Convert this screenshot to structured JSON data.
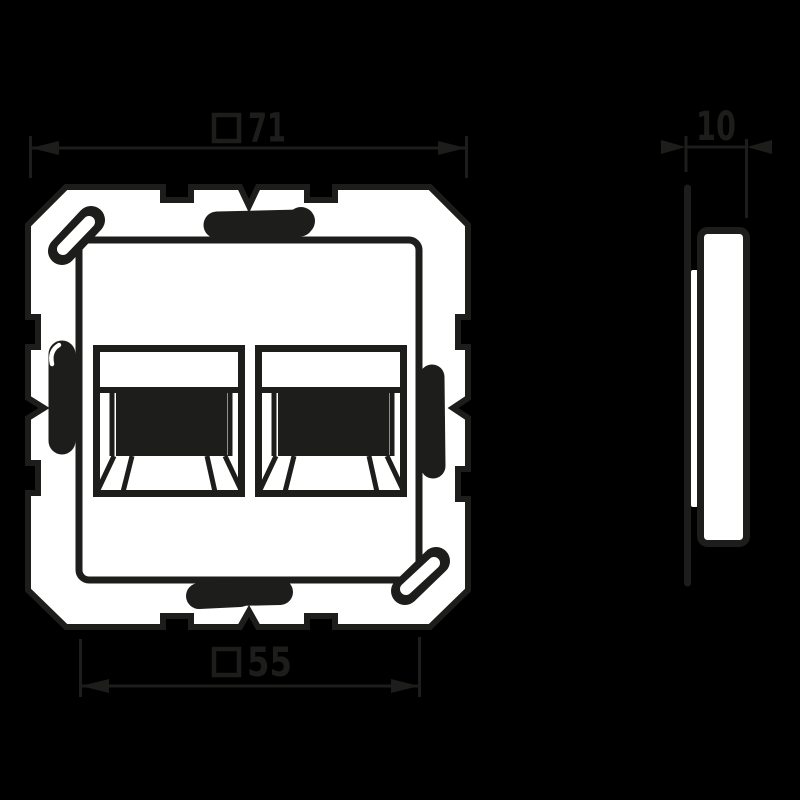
{
  "drawing": {
    "kind": "technical dimension drawing",
    "subject": "2-port modular jack cover plate with mounting frame",
    "views": [
      {
        "id": "front",
        "label": "front view"
      },
      {
        "id": "side",
        "label": "side view"
      }
    ]
  },
  "dimensions": {
    "outer_width": {
      "symbol": "□",
      "value": "71"
    },
    "plate_width": {
      "symbol": "□",
      "value": "55"
    },
    "depth": {
      "value": "10"
    }
  },
  "colors": {
    "background": "#000000",
    "ink": "#1d1d1b",
    "surface": "#ffffff"
  }
}
